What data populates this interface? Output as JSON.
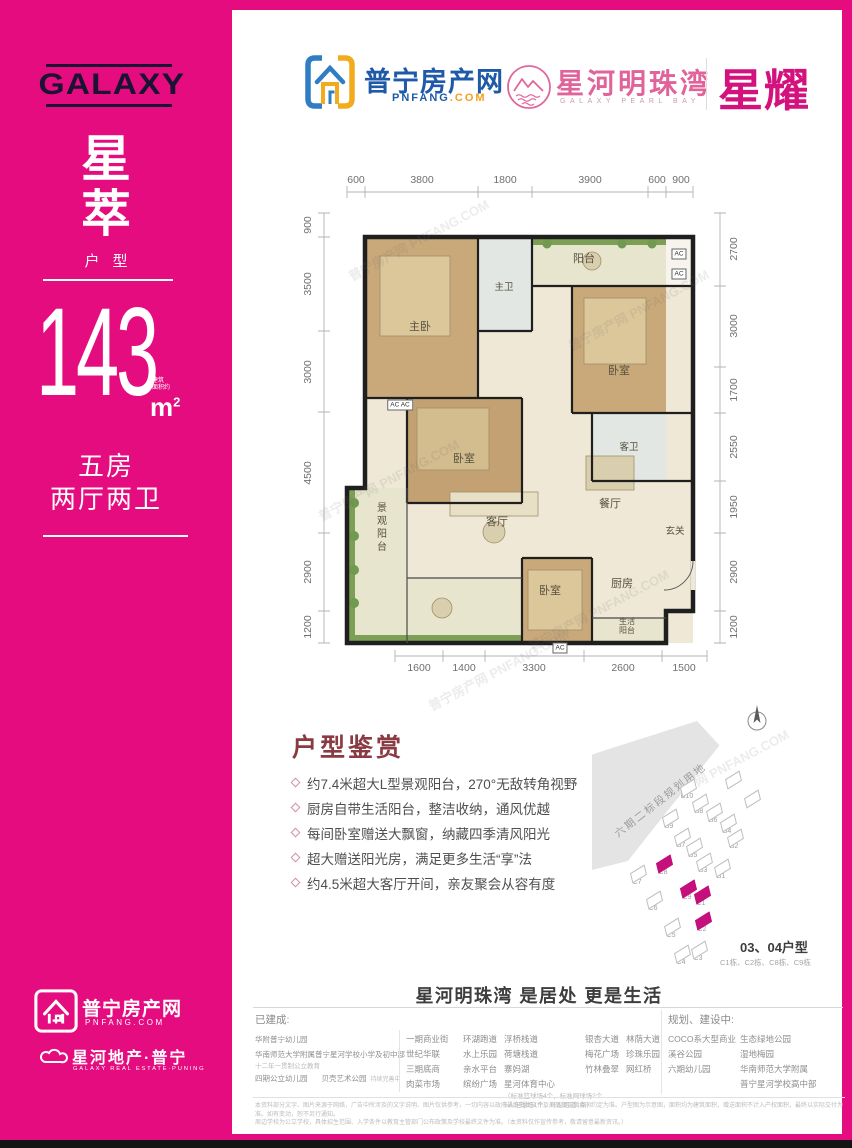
{
  "sidebar": {
    "brand": "GALAXY",
    "name_char1": "星",
    "name_char2": "萃",
    "type_label": "户型",
    "area_value": "143",
    "area_note_line1": "建筑",
    "area_note_line2": "面积约",
    "area_unit": "m",
    "area_unit_sup": "2",
    "rooms_line1": "五房",
    "rooms_line2": "两厅两卫",
    "footer_logo1_title": "普宁房产网",
    "footer_logo1_sub": "PNFANG.COM",
    "footer_logo2_title": "星河地产·普宁",
    "footer_logo2_sub": "GALAXY REAL ESTATE·PUNING"
  },
  "header": {
    "pnfang_title": "普宁房产网",
    "pnfang_domain_main": "PNFANG",
    "pnfang_domain_suffix": ".COM",
    "project_title": "星河明珠湾",
    "project_sub": "GALAXY PEARL BAY",
    "badge": "星耀"
  },
  "floorplan": {
    "dims_top": [
      "600",
      "3800",
      "1800",
      "3900",
      "600",
      "900"
    ],
    "dims_left": [
      "900",
      "3500",
      "3000",
      "4500",
      "2900",
      "1200"
    ],
    "dims_right": [
      "2700",
      "3000",
      "1700",
      "2550",
      "1950",
      "2900",
      "1200"
    ],
    "dims_bottom": [
      "1600",
      "1400",
      "3300",
      "2600",
      "1500"
    ],
    "rooms": {
      "balcony": "阳台",
      "master_bath": "主卫",
      "master_bedroom": "主卧",
      "bedroom_mid": "卧室",
      "bedroom_right": "卧室",
      "guest_bath": "客卫",
      "dining": "餐厅",
      "living": "客厅",
      "foyer": "玄关",
      "view_balcony": "景观阳台",
      "bedroom_bottom": "卧室",
      "kitchen": "厨房",
      "service_balcony_l1": "生活",
      "service_balcony_l2": "阳台",
      "ac": "AC",
      "ac_pair": "AC AC"
    },
    "watermark": "普宁房产网 PNFANG.COM"
  },
  "appreciation": {
    "title": "户型鉴赏",
    "bullets": [
      "约7.4米超大L型景观阳台，270°无敌转角视野",
      "厨房自带生活阳台，整洁收纳，通风优越",
      "每间卧室赠送大飘窗，纳藏四季清风阳光",
      "超大赠送阳光房，满足更多生活“享”法",
      "约4.5米超大客厅开间，亲友聚会从容有度"
    ]
  },
  "siteplan": {
    "plot_note": "六期二标段规划用地",
    "caption_title": "03、04户型",
    "caption_sub": "C1栋、C2栋、C8栋、C9栋",
    "buildings": [
      {
        "label": "B10",
        "x": 88,
        "y": 88
      },
      {
        "label": "B8",
        "x": 100,
        "y": 103
      },
      {
        "label": "B6",
        "x": 114,
        "y": 112
      },
      {
        "label": "B9",
        "x": 70,
        "y": 118
      },
      {
        "label": "B4",
        "x": 128,
        "y": 123
      },
      {
        "label": "B7",
        "x": 82,
        "y": 137
      },
      {
        "label": "B2",
        "x": 135,
        "y": 138
      },
      {
        "label": "B5",
        "x": 94,
        "y": 147
      },
      {
        "label": "B3",
        "x": 104,
        "y": 162
      },
      {
        "label": "B1",
        "x": 122,
        "y": 168
      },
      {
        "label": "C7",
        "x": 38,
        "y": 174
      },
      {
        "label": "C8",
        "x": 64,
        "y": 164,
        "hl": true
      },
      {
        "label": "C9",
        "x": 88,
        "y": 189,
        "hl": true
      },
      {
        "label": "C1",
        "x": 102,
        "y": 195,
        "hl": true
      },
      {
        "label": "C6",
        "x": 54,
        "y": 200
      },
      {
        "label": "C2",
        "x": 103,
        "y": 221,
        "hl": true
      },
      {
        "label": "C5",
        "x": 72,
        "y": 227
      },
      {
        "label": "C3",
        "x": 99,
        "y": 250
      },
      {
        "label": "C4",
        "x": 82,
        "y": 254
      },
      {
        "label": "",
        "x": 133,
        "y": 80
      },
      {
        "label": "",
        "x": 152,
        "y": 99
      }
    ]
  },
  "slogan": "星河明珠湾 是居处 更是生活",
  "facilities": {
    "built_label": "已建成:",
    "planning_label": "规划、建设中:",
    "built_col1": [
      "华附普宁幼儿园",
      "华南师范大学附属普宁星河学校小学及初中部"
    ],
    "built_col1_note": "十二年一贯制公立教育",
    "built_col1_row3a": "四期公立幼儿园",
    "built_col1_row3b": "贝壳艺术公园",
    "built_col1_row3note": "持续完善中",
    "built_col2": [
      "一期商业街",
      "世纪华联",
      "三期底商",
      "肉菜市场"
    ],
    "built_col3": [
      "环湖跑道",
      "水上乐园",
      "亲水平台",
      "缤纷广场"
    ],
    "built_col4": [
      "浮桥栈道",
      "荷塘栈道",
      "寨妈湖",
      "星河体育中心"
    ],
    "built_col4_note1": "（标准篮球场4个，标准网球场2个",
    "built_col4_note2": "5人足球场1个，环形跑道1条）",
    "built_col5": [
      "银杏大道",
      "梅花广场",
      "竹林叠翠"
    ],
    "built_col6": [
      "林荫大道",
      "珍珠乐园",
      "网红桥"
    ],
    "plan_col1": [
      "COCO系大型商业",
      "溪谷公园",
      "六期幼儿园"
    ],
    "plan_col2": [
      "生态绿地公园",
      "湿地梅园",
      "华南师范大学附属",
      "普宁星河学校高中部"
    ]
  },
  "disclaimer": {
    "line1": "本资料部分文字、图片来源于网络，广告中所涉及的文字说明、图片仅供参考，一切内容以政府最终批复文件及商品房买卖合同约定为准。户型图为示意图，面积均为建筑面积，赠送面积不计入产权面积，最终以实际交付为准。如有变动，恕不另行通知。",
    "line2": "周边学校为公立学校，具体招生范围、入学条件以教育主管部门公布政策及学校最终文件为准。（本资料仅作宣传参考，敬请留意最新资讯。）"
  }
}
